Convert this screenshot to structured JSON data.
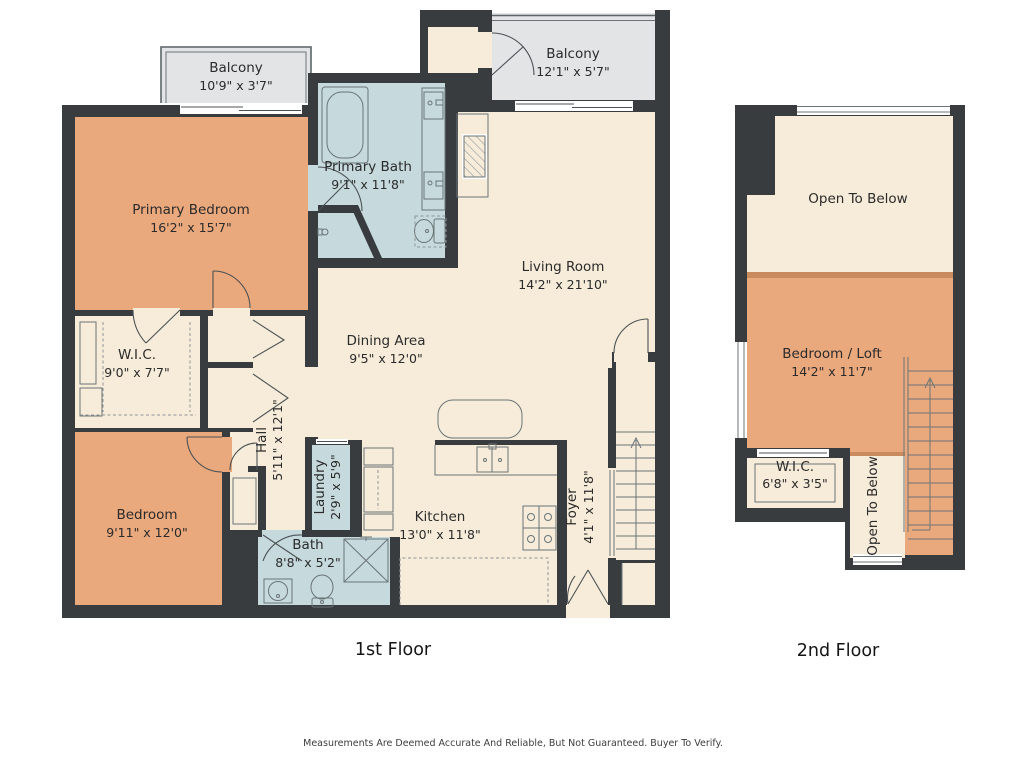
{
  "floors": {
    "first": {
      "title": "1st Floor",
      "rooms": {
        "balcony_left": {
          "label": "Balcony",
          "dims": "10'9\" x 3'7\""
        },
        "balcony_right": {
          "label": "Balcony",
          "dims": "12'1\" x 5'7\""
        },
        "primary_bedroom": {
          "label": "Primary Bedroom",
          "dims": "16'2\" x 15'7\""
        },
        "primary_bath": {
          "label": "Primary Bath",
          "dims": "9'1\" x 11'8\""
        },
        "living_room": {
          "label": "Living Room",
          "dims": "14'2\" x 21'10\""
        },
        "dining_area": {
          "label": "Dining Area",
          "dims": "9'5\" x 12'0\""
        },
        "wic": {
          "label": "W.I.C.",
          "dims": "9'0\" x 7'7\""
        },
        "hall": {
          "label": "Hall",
          "dims": "5'11\" x 12'1\""
        },
        "laundry": {
          "label": "Laundry",
          "dims": "2'9\" x 5'9\""
        },
        "bedroom": {
          "label": "Bedroom",
          "dims": "9'11\" x 12'0\""
        },
        "bath": {
          "label": "Bath",
          "dims": "8'8\" x 5'2\""
        },
        "kitchen": {
          "label": "Kitchen",
          "dims": "13'0\" x 11'8\""
        },
        "foyer": {
          "label": "Foyer",
          "dims": "4'1\" x 11'8\""
        }
      }
    },
    "second": {
      "title": "2nd Floor",
      "rooms": {
        "open_to_below_top": {
          "label": "Open To Below"
        },
        "bedroom_loft": {
          "label": "Bedroom / Loft",
          "dims": "14'2\" x 11'7\""
        },
        "wic": {
          "label": "W.I.C.",
          "dims": "6'8\" x 3'5\""
        },
        "open_to_below_bottom": {
          "label": "Open To Below"
        }
      }
    }
  },
  "disclaimer": "Measurements Are Deemed Accurate And Reliable, But Not Guaranteed. Buyer To Verify.",
  "colors": {
    "wall": "#383c3f",
    "bedroom": "#eaa87d",
    "bath": "#c6dadd",
    "floor": "#f6ecd9",
    "balcony": "#e3e4e6",
    "loft_edge": "#c98a5e",
    "fixture_line": "#6b7477",
    "text": "#2b2b2b"
  }
}
